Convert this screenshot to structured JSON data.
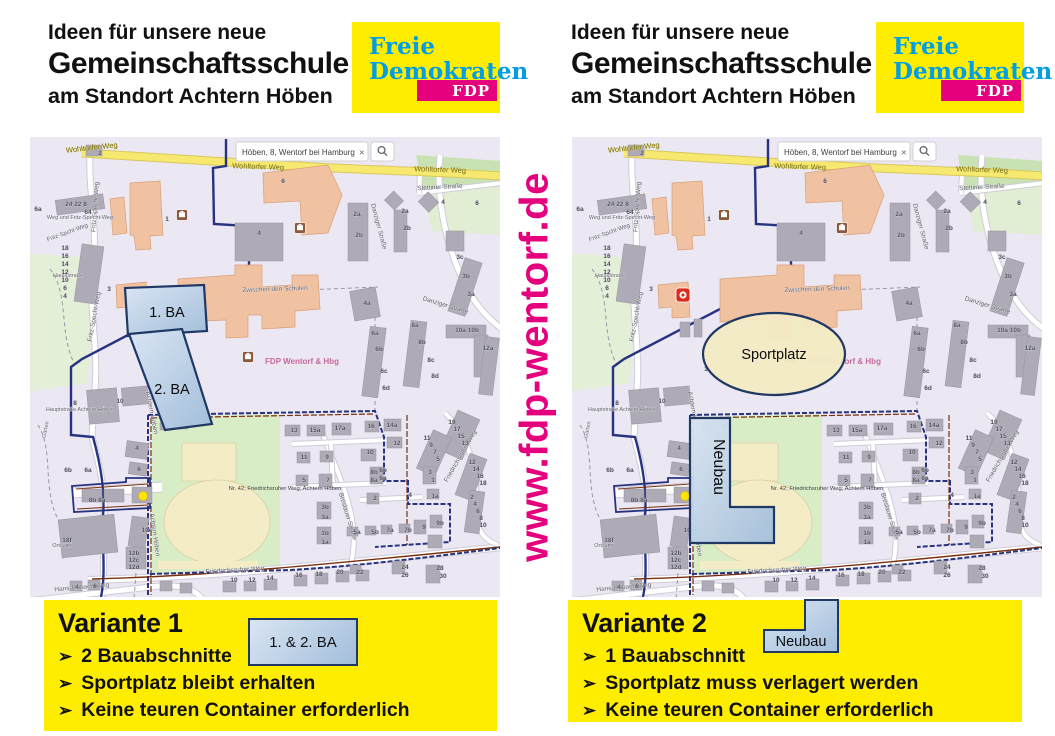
{
  "header": {
    "line1": "Ideen für unsere neue",
    "line2": "Gemeinschaftsschule",
    "line3": "am Standort Achtern Höben"
  },
  "logo": {
    "line1": "Freie",
    "line2": "Demokraten",
    "badge": "FDP"
  },
  "website": "www.fdp-wentorf.de",
  "colors": {
    "brand_yellow": "#ffed00",
    "brand_cyan": "#009ee3",
    "brand_magenta": "#e5007d",
    "overlay_blue_light": "#d9e5f3",
    "overlay_blue_dark": "#a3bedb",
    "overlay_border": "#1f3864",
    "sportplatz_fill": "#f3e9c4",
    "map_boundary_navy": "#27337f",
    "map_boundary_red": "#7a2f0f"
  },
  "map": {
    "search": {
      "value": "Höben, 8, Wentorf bei Hamburg",
      "close": "×",
      "button": "magnifier"
    },
    "watermark": "FDP Wentorf & Hbg",
    "note": "Nr. 42; Friedrichsruher Weg; Achtern Höben",
    "streets": [
      {
        "t": "Wohltorfer Weg",
        "x": 62,
        "y": 13,
        "r": -6,
        "s": 7.5,
        "k": "yellow"
      },
      {
        "t": "Wohltorfer Weg",
        "x": 228,
        "y": 32,
        "r": 2,
        "s": 7.5,
        "k": "yellow"
      },
      {
        "t": "Wohltorfer Weg",
        "x": 410,
        "y": 35,
        "r": 2,
        "s": 7.5,
        "k": "yellow"
      },
      {
        "t": "Stettiner Straße",
        "x": 410,
        "y": 52,
        "r": -3,
        "s": 6.5
      },
      {
        "t": "Fritz-Specht-Weg",
        "x": 67,
        "y": 70,
        "r": -86,
        "s": 6.5
      },
      {
        "t": "Fritz-Specht-Weg",
        "x": 66,
        "y": 180,
        "r": -80,
        "s": 6.5
      },
      {
        "t": "Fritz-Spcht-Weg",
        "x": 38,
        "y": 97,
        "r": -20,
        "s": 6
      },
      {
        "t": "Weg und Fritz-Specht-Weg",
        "x": 50,
        "y": 82,
        "r": 0,
        "s": 5.5
      },
      {
        "t": "Zwischen den Schulen",
        "x": 245,
        "y": 154,
        "r": -2,
        "s": 6.5
      },
      {
        "t": "Danziger Straße",
        "x": 347,
        "y": 90,
        "r": 75,
        "s": 6.5
      },
      {
        "t": "Danziger Straße",
        "x": 415,
        "y": 170,
        "r": 17,
        "s": 6.5
      },
      {
        "t": "Achtern Höben",
        "x": 120,
        "y": 276,
        "r": 79,
        "s": 6.5
      },
      {
        "t": "Achtern Höben",
        "x": 123,
        "y": 398,
        "r": 82,
        "s": 6.5
      },
      {
        "t": "Hauptstraße",
        "x": 38,
        "y": 140,
        "r": 0,
        "s": 5.5
      },
      {
        "t": "Hauptstraße Achtern Höben",
        "x": 50,
        "y": 274,
        "r": 0,
        "s": 5.5
      },
      {
        "t": "Garten",
        "x": 17,
        "y": 293,
        "r": -78,
        "s": 5.5
      },
      {
        "t": "Ortsamt",
        "x": 32,
        "y": 410,
        "r": 0,
        "s": 5.5
      },
      {
        "t": "Hans-Rubach-Weg",
        "x": 52,
        "y": 452,
        "r": -5,
        "s": 6.5
      },
      {
        "t": "Friedrichsruher Weg",
        "x": 205,
        "y": 435,
        "r": -3,
        "s": 6.5
      },
      {
        "t": "Friedrichsruher Weg",
        "x": 432,
        "y": 320,
        "r": -60,
        "s": 6.5
      },
      {
        "t": "Breslauer Straße",
        "x": 316,
        "y": 380,
        "r": 73,
        "s": 6.5
      }
    ],
    "numbers": [
      {
        "t": "2",
        "x": 70,
        "y": 18
      },
      {
        "t": "24 22 8",
        "x": 46,
        "y": 69
      },
      {
        "t": "64",
        "x": 58,
        "y": 77
      },
      {
        "t": "6a",
        "x": 8,
        "y": 74
      },
      {
        "t": "1",
        "x": 137,
        "y": 84
      },
      {
        "t": "6",
        "x": 253,
        "y": 46
      },
      {
        "t": "4",
        "x": 229,
        "y": 98
      },
      {
        "t": "2a",
        "x": 327,
        "y": 79
      },
      {
        "t": "2b",
        "x": 329,
        "y": 100
      },
      {
        "t": "4",
        "x": 413,
        "y": 67
      },
      {
        "t": "6",
        "x": 447,
        "y": 68
      },
      {
        "t": "2a",
        "x": 375,
        "y": 76
      },
      {
        "t": "2b",
        "x": 377,
        "y": 93
      },
      {
        "t": "3c",
        "x": 430,
        "y": 122
      },
      {
        "t": "3b",
        "x": 436,
        "y": 141
      },
      {
        "t": "3a",
        "x": 441,
        "y": 159
      },
      {
        "t": "18",
        "x": 35,
        "y": 113
      },
      {
        "t": "16",
        "x": 35,
        "y": 121
      },
      {
        "t": "14",
        "x": 35,
        "y": 129
      },
      {
        "t": "12",
        "x": 35,
        "y": 137
      },
      {
        "t": "10",
        "x": 35,
        "y": 145
      },
      {
        "t": "6",
        "x": 35,
        "y": 153
      },
      {
        "t": "4",
        "x": 35,
        "y": 161
      },
      {
        "t": "4a",
        "x": 337,
        "y": 168
      },
      {
        "t": "6a",
        "x": 345,
        "y": 198
      },
      {
        "t": "6b",
        "x": 349,
        "y": 214
      },
      {
        "t": "6c",
        "x": 354,
        "y": 236
      },
      {
        "t": "6d",
        "x": 356,
        "y": 253
      },
      {
        "t": "8a",
        "x": 385,
        "y": 190
      },
      {
        "t": "8b",
        "x": 392,
        "y": 207
      },
      {
        "t": "8c",
        "x": 401,
        "y": 225
      },
      {
        "t": "8d",
        "x": 405,
        "y": 241
      },
      {
        "t": "10a 10b",
        "x": 437,
        "y": 195
      },
      {
        "t": "12a",
        "x": 458,
        "y": 213
      },
      {
        "t": "3",
        "x": 79,
        "y": 154
      },
      {
        "t": "3",
        "x": 134,
        "y": 234
      },
      {
        "t": "8",
        "x": 45,
        "y": 268
      },
      {
        "t": "10",
        "x": 90,
        "y": 266
      },
      {
        "t": "4",
        "x": 107,
        "y": 313
      },
      {
        "t": "6",
        "x": 109,
        "y": 334
      },
      {
        "t": "6b",
        "x": 38,
        "y": 335
      },
      {
        "t": "6a",
        "x": 58,
        "y": 335
      },
      {
        "t": "8b 8a",
        "x": 67,
        "y": 365
      },
      {
        "t": "10c",
        "x": 117,
        "y": 395
      },
      {
        "t": "18f",
        "x": 37,
        "y": 405
      },
      {
        "t": "12b",
        "x": 104,
        "y": 418
      },
      {
        "t": "12c",
        "x": 104,
        "y": 425
      },
      {
        "t": "12d",
        "x": 104,
        "y": 432
      },
      {
        "t": "13",
        "x": 264,
        "y": 295
      },
      {
        "t": "15a",
        "x": 285,
        "y": 295
      },
      {
        "t": "17a",
        "x": 310,
        "y": 293
      },
      {
        "t": "16",
        "x": 341,
        "y": 291
      },
      {
        "t": "14a",
        "x": 362,
        "y": 290
      },
      {
        "t": "12",
        "x": 367,
        "y": 308
      },
      {
        "t": "10",
        "x": 340,
        "y": 317
      },
      {
        "t": "11",
        "x": 274,
        "y": 322
      },
      {
        "t": "9",
        "x": 297,
        "y": 322
      },
      {
        "t": "8b",
        "x": 344,
        "y": 337
      },
      {
        "t": "8a",
        "x": 344,
        "y": 345
      },
      {
        "t": "6b",
        "x": 353,
        "y": 335
      },
      {
        "t": "6a",
        "x": 353,
        "y": 343
      },
      {
        "t": "5",
        "x": 274,
        "y": 345
      },
      {
        "t": "7",
        "x": 298,
        "y": 345
      },
      {
        "t": "2",
        "x": 345,
        "y": 363
      },
      {
        "t": "3b",
        "x": 295,
        "y": 372
      },
      {
        "t": "3a",
        "x": 295,
        "y": 382
      },
      {
        "t": "4",
        "x": 380,
        "y": 360
      },
      {
        "t": "1b",
        "x": 295,
        "y": 398
      },
      {
        "t": "1a",
        "x": 295,
        "y": 407
      },
      {
        "t": "5a",
        "x": 327,
        "y": 397
      },
      {
        "t": "5b",
        "x": 345,
        "y": 397
      },
      {
        "t": "7a",
        "x": 360,
        "y": 395
      },
      {
        "t": "7b",
        "x": 378,
        "y": 395
      },
      {
        "t": "9",
        "x": 394,
        "y": 392
      },
      {
        "t": "9b",
        "x": 410,
        "y": 388
      },
      {
        "t": "19",
        "x": 422,
        "y": 287
      },
      {
        "t": "17",
        "x": 427,
        "y": 294
      },
      {
        "t": "15",
        "x": 431,
        "y": 301
      },
      {
        "t": "13",
        "x": 435,
        "y": 308
      },
      {
        "t": "11",
        "x": 397,
        "y": 303
      },
      {
        "t": "9",
        "x": 401,
        "y": 310
      },
      {
        "t": "7",
        "x": 405,
        "y": 317
      },
      {
        "t": "5",
        "x": 408,
        "y": 324
      },
      {
        "t": "12",
        "x": 442,
        "y": 327
      },
      {
        "t": "14",
        "x": 446,
        "y": 334
      },
      {
        "t": "16",
        "x": 450,
        "y": 341
      },
      {
        "t": "18",
        "x": 453,
        "y": 348
      },
      {
        "t": "3",
        "x": 400,
        "y": 337
      },
      {
        "t": "1",
        "x": 403,
        "y": 345
      },
      {
        "t": "1a",
        "x": 405,
        "y": 361
      },
      {
        "t": "2",
        "x": 442,
        "y": 362
      },
      {
        "t": "4",
        "x": 445,
        "y": 369
      },
      {
        "t": "6",
        "x": 448,
        "y": 376
      },
      {
        "t": "8",
        "x": 451,
        "y": 383
      },
      {
        "t": "10",
        "x": 453,
        "y": 390
      },
      {
        "t": "10",
        "x": 204,
        "y": 445
      },
      {
        "t": "12",
        "x": 222,
        "y": 445
      },
      {
        "t": "14",
        "x": 240,
        "y": 443
      },
      {
        "t": "16",
        "x": 269,
        "y": 440
      },
      {
        "t": "18",
        "x": 289,
        "y": 439
      },
      {
        "t": "20",
        "x": 310,
        "y": 437
      },
      {
        "t": "22",
        "x": 330,
        "y": 437
      },
      {
        "t": "24",
        "x": 375,
        "y": 432
      },
      {
        "t": "26",
        "x": 375,
        "y": 440
      },
      {
        "t": "28",
        "x": 410,
        "y": 433
      },
      {
        "t": "30",
        "x": 413,
        "y": 441
      },
      {
        "t": "4",
        "x": 47,
        "y": 452
      },
      {
        "t": "6",
        "x": 65,
        "y": 451
      }
    ]
  },
  "variant1": {
    "title": "Variante 1",
    "bullets": [
      "2 Bauabschnitte",
      "Sportplatz bleibt erhalten",
      "Keine teuren Container erforderlich"
    ],
    "legend": "1. & 2. BA",
    "overlay_ba1": "1. BA",
    "overlay_ba2": "2. BA"
  },
  "variant2": {
    "title": "Variante 2",
    "bullets": [
      "1 Bauabschnitt",
      "Sportplatz muss verlagert werden",
      "Keine teuren Container erforderlich"
    ],
    "legend": "Neubau",
    "overlay_sportplatz": "Sportplatz",
    "overlay_neubau": "Neubau"
  }
}
